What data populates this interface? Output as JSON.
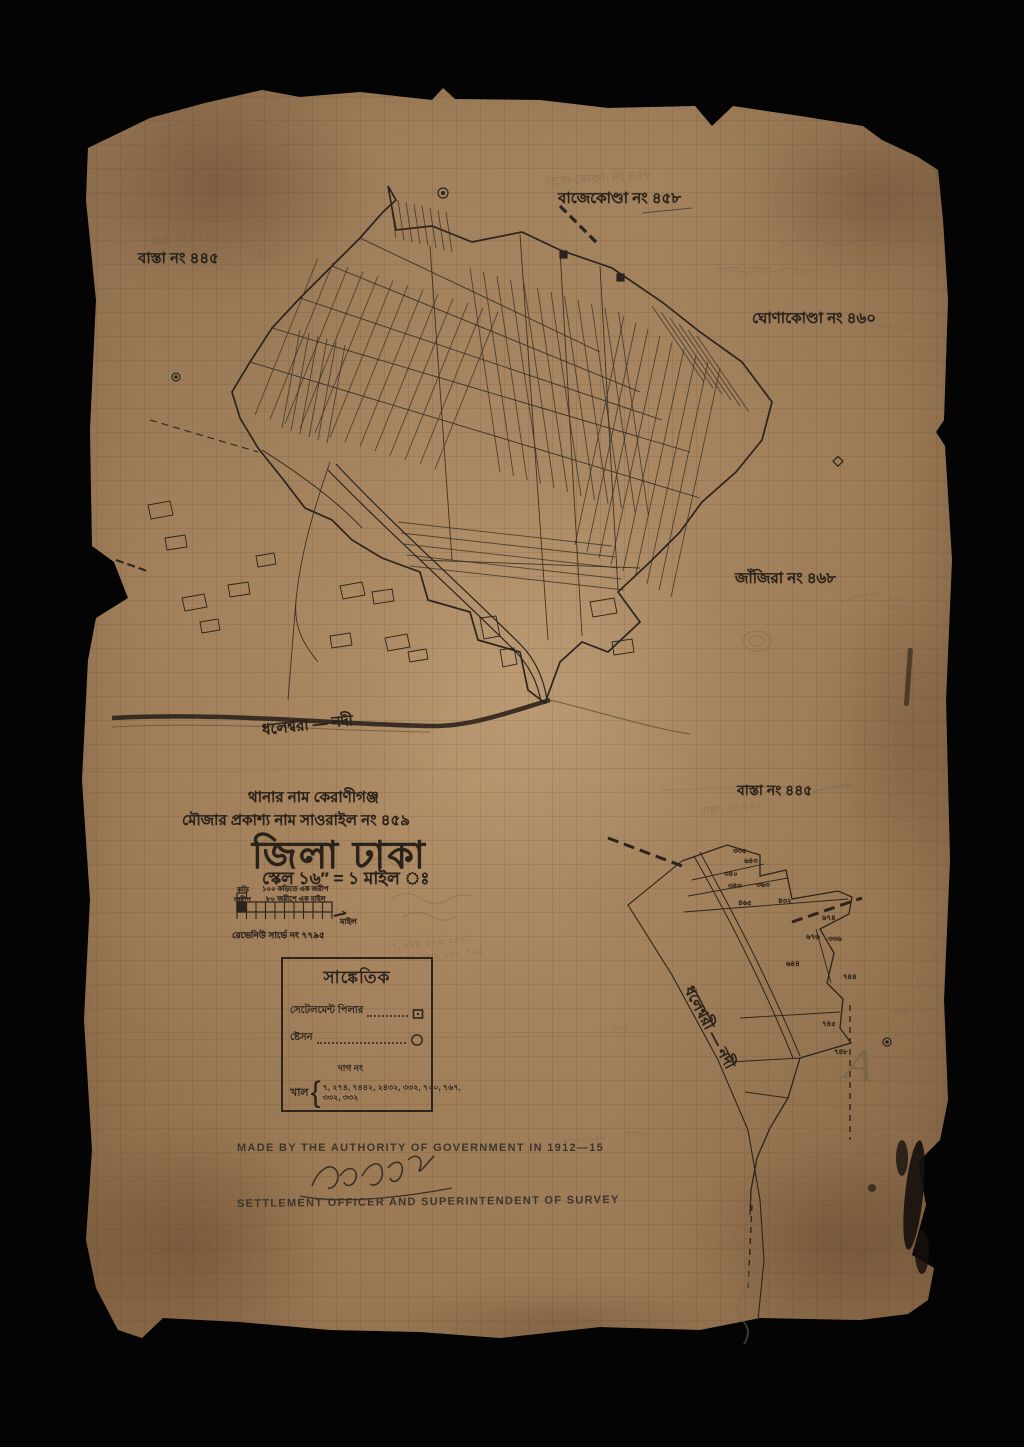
{
  "page": {
    "background_color": "#050505",
    "paper_color": "#b08c64",
    "ink_color": "#2b241c",
    "pencil_color": "#7a6a52"
  },
  "labels": {
    "bajekonda": "বাজেকোণ্ডা নং ৪৫৮",
    "basta_left": "বাস্তা নং ৪৪৫",
    "ghonakonda": "ঘোণাকোণ্ডা নং ৪৬০",
    "janjira": "জাঁজিরা নং ৪৬৮",
    "river_main": "ধলেশ্বরা — নদী",
    "basta_right": "বাস্তা নং ৪৪৫",
    "river_inset": "ধলেশ্বরী — নদী"
  },
  "title_block": {
    "line1": "থানার নাম কেরাণীগঞ্জ",
    "line2": "মৌজার প্রকাশ্য নাম  সাওরাইল নং ৪৫৯",
    "district": "জিলা ঢাকা",
    "scale": "স্কেল ১৬″ = ১ মাইল ঃ"
  },
  "scale_bar": {
    "note1": "১০০ কড়িতে এক জরীপ",
    "note2": "৮০ জরীপে এক মাইল",
    "left1": "কড়ি",
    "left2": "জরীপ",
    "right_word": "মাইল",
    "revenue": "রেভেনিউ সার্ভে নং ৭৭৯৫"
  },
  "legend": {
    "heading": "সাঙ্কেতিক",
    "row_pillar": "সেটেলমেন্ট পিলার",
    "row_station": "ষ্টেসন",
    "dag_no": "দাগ নং",
    "khal_label": "খাল",
    "khal_numbers_1": "৭, ২৭৪, ৭৪৪২, ২৪৩২, ৩৩২, ৭০০, ৭৬৭,",
    "khal_numbers_2": "৩৩২, ৩৩২"
  },
  "footer": {
    "made_by": "MADE BY THE AUTHORITY OF GOVERNMENT IN 1912—15",
    "officer": "SETTLEMENT OFFICER AND SUPERINTENDENT OF SURVEY"
  },
  "inset": {
    "parcels": [
      "৩৩৫",
      "৬৪৩",
      "৩৪০",
      "৩৪৩",
      "৩৬৩",
      "৪৬৫",
      "৪৩২",
      "৬৭৪",
      "৬৭৬",
      "৩৩৬",
      "৬৪৪",
      "৭৪৪",
      "৭৪৫",
      "৭৪৮"
    ]
  },
  "pencil_notes": {
    "bajekonda": "বাজে-কোণ্ডা- নং ৪৫৮",
    "basta_left": "বাস্তা নং ৪৪৫",
    "ghonakonda": "ঘোনা-কোণ্ডা- নং ৪৬০",
    "basta_right": "বাস্তা- নং ৪৪৫",
    "nums1": "৭, ২৪৪, ২০০, ২৫০,",
    "nums2": "৭৩২, ২০৬, ২০০, ৭৩২",
    "stack1": "৫৮৮২",
    "stack2": "৬৮৮২",
    "stack3": "৬৩২",
    "letter_a": "A",
    "n1": "৬৭-৭৪২-৪৩",
    "n2": "৪৩ ৬২",
    "n3": "৩২৮",
    "n4": "৭০০",
    "n5": "৬৫৮",
    "n6": "২০৩"
  }
}
